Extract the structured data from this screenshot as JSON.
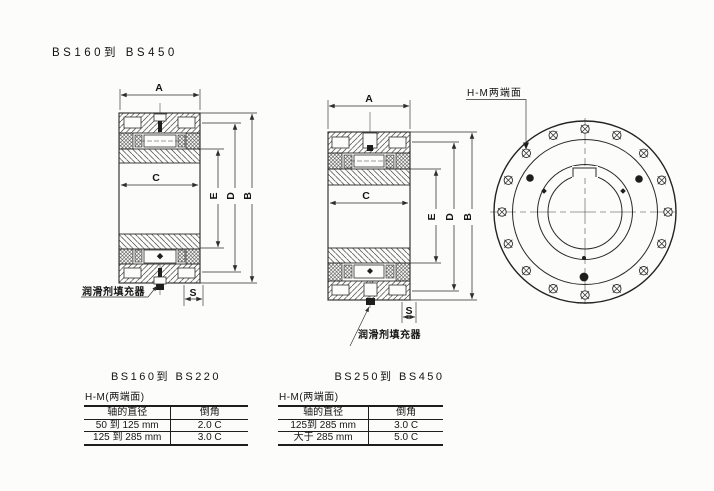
{
  "page_title": "BS160到 BS450",
  "dims": {
    "a": "A",
    "b": "B",
    "c": "C",
    "d": "D",
    "e": "E",
    "s": "S"
  },
  "labels": {
    "lubricant_filler": "润滑剂填充器",
    "hm_faces": "H-M两端面"
  },
  "tables": [
    {
      "title": "BS160到 BS220",
      "subtitle": "H-M(两端面)",
      "columns": [
        "轴的直径",
        "倒角"
      ],
      "rows": [
        [
          "50 到 125 mm",
          "2.0 C"
        ],
        [
          "125 到 285 mm",
          "3.0 C"
        ]
      ]
    },
    {
      "title": "BS250到 BS450",
      "subtitle": "H-M(两端面)",
      "columns": [
        "轴的直径",
        "倒角"
      ],
      "rows": [
        [
          "125到 285 mm",
          "3.0 C"
        ],
        [
          "大于 285 mm",
          "5.0 C"
        ]
      ]
    }
  ],
  "colors": {
    "ink": "#151515",
    "line": "#2e2e2e",
    "paper": "#fcfcfb"
  }
}
